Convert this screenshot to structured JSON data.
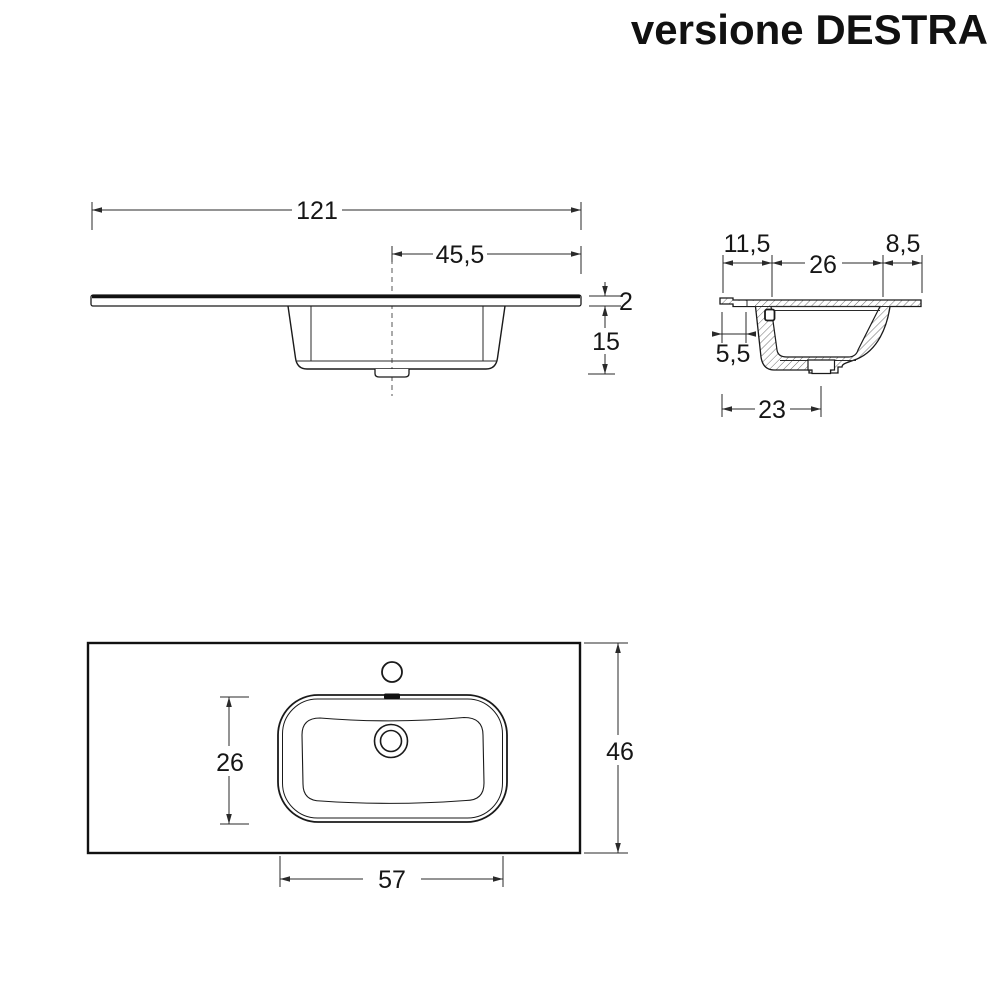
{
  "title": "versione DESTRA",
  "front_view": {
    "overall_width": "121",
    "tap_to_right_edge": "45,5",
    "top_thickness": "2",
    "basin_depth": "15"
  },
  "side_view": {
    "front_edge": "11,5",
    "basin_inner_width": "26",
    "back_edge": "8,5",
    "front_lip": "5,5",
    "basin_base": "23"
  },
  "top_view": {
    "basin_depth": "26",
    "overall_depth": "46",
    "basin_width": "57"
  },
  "colors": {
    "line": "#1a1a1a",
    "background": "#ffffff"
  }
}
